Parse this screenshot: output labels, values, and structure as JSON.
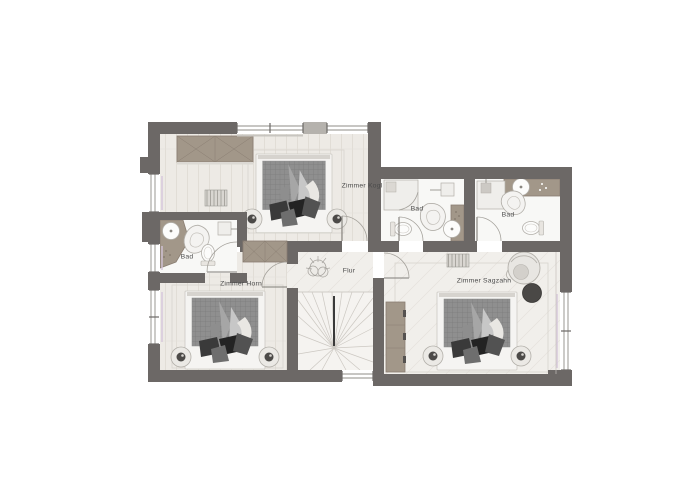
{
  "rooms": {
    "zimmer_kogl": {
      "label": "Zimmer Kogl"
    },
    "bad_mitte": {
      "label": "Bad"
    },
    "bad_rechts": {
      "label": "Bad"
    },
    "bad_links": {
      "label": "Bad"
    },
    "zimmer_horn": {
      "label": "Zimmer Horn"
    },
    "flur": {
      "label": "Flur"
    },
    "zimmer_sagzahn": {
      "label": "Zimmer Sagzahn"
    }
  },
  "colors": {
    "wall": "#6c6866",
    "floor_plank": "#edeae5",
    "floor_tile": "#f1efeb",
    "bath_floor": "#f8f8f6",
    "furniture_tan": "#a29789",
    "furniture_tan_border": "#8a7e72",
    "duvet": "#8f8f8f",
    "pillow_dark": "#2e2e2e",
    "fixture_stroke": "#b2afa9",
    "curtain": "#d5c5db",
    "door_arc": "#a5a29c",
    "stair_line": "#ccc8c2",
    "label_text": "#4b4b4b"
  }
}
